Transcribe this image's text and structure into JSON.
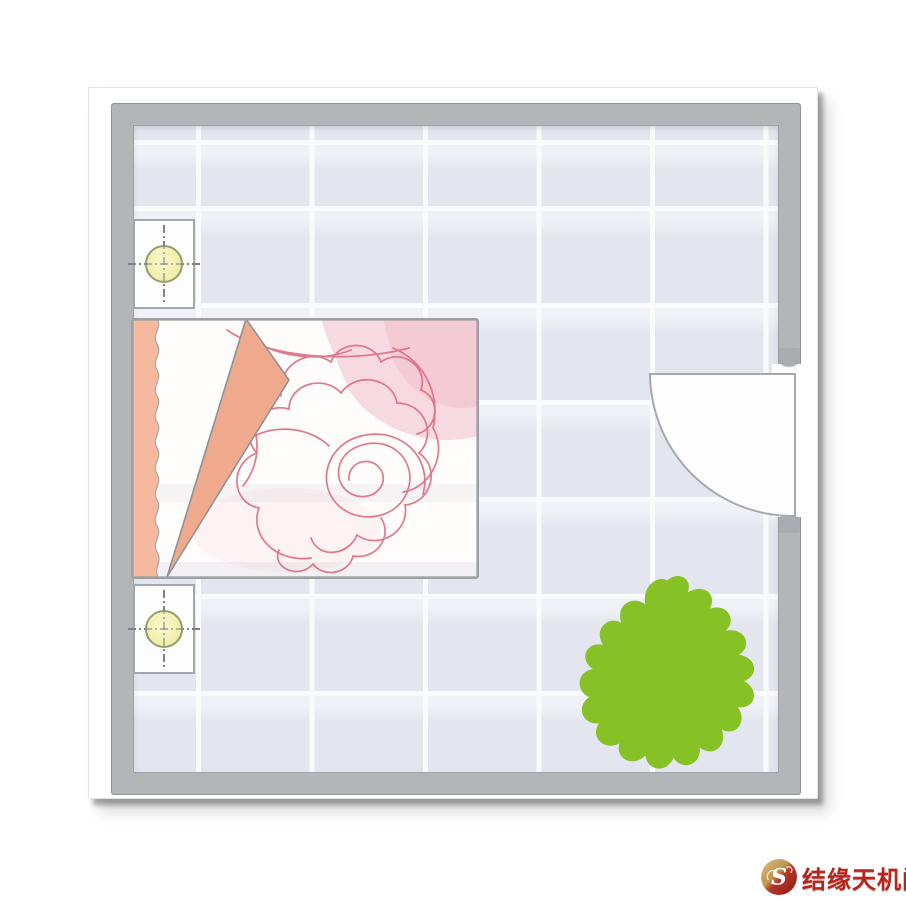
{
  "meta": {
    "kind": "bedroom floor plan diagram",
    "description": "Top-view bedroom layout: bed with rose-patterned cover along left wall, nightstand with lamp above and below the bed, door with quarter-circle swing on right wall, green plant near bottom-right corner, tiled floor"
  },
  "room": {
    "wall_color": "#b3b5b7",
    "floor_tile_color": "#e3e6ee",
    "grout_color": "#f9fafc",
    "items": [
      {
        "name": "nightstand-top",
        "kind": "nightstand with round lamp",
        "lamp_color": "#f1eeab"
      },
      {
        "name": "bed",
        "kind": "double bed with rose-doodle cover",
        "pillow_color": "#f6b99e",
        "fold_color": "#efaa8d",
        "rose_line_color": "#dd7188",
        "shade_color": "#f5d0d9"
      },
      {
        "name": "nightstand-bottom",
        "kind": "nightstand with round lamp",
        "lamp_color": "#f1eeab"
      },
      {
        "name": "door",
        "kind": "door opening with 90-degree swing arc",
        "position": "right wall"
      },
      {
        "name": "plant",
        "kind": "plant splat (top view)",
        "color": "#86c226"
      }
    ]
  },
  "watermark": {
    "text": "结缘天机阁",
    "text_color": "#b5251c",
    "logo_icon": "gold-red-s-swirl-seal"
  }
}
